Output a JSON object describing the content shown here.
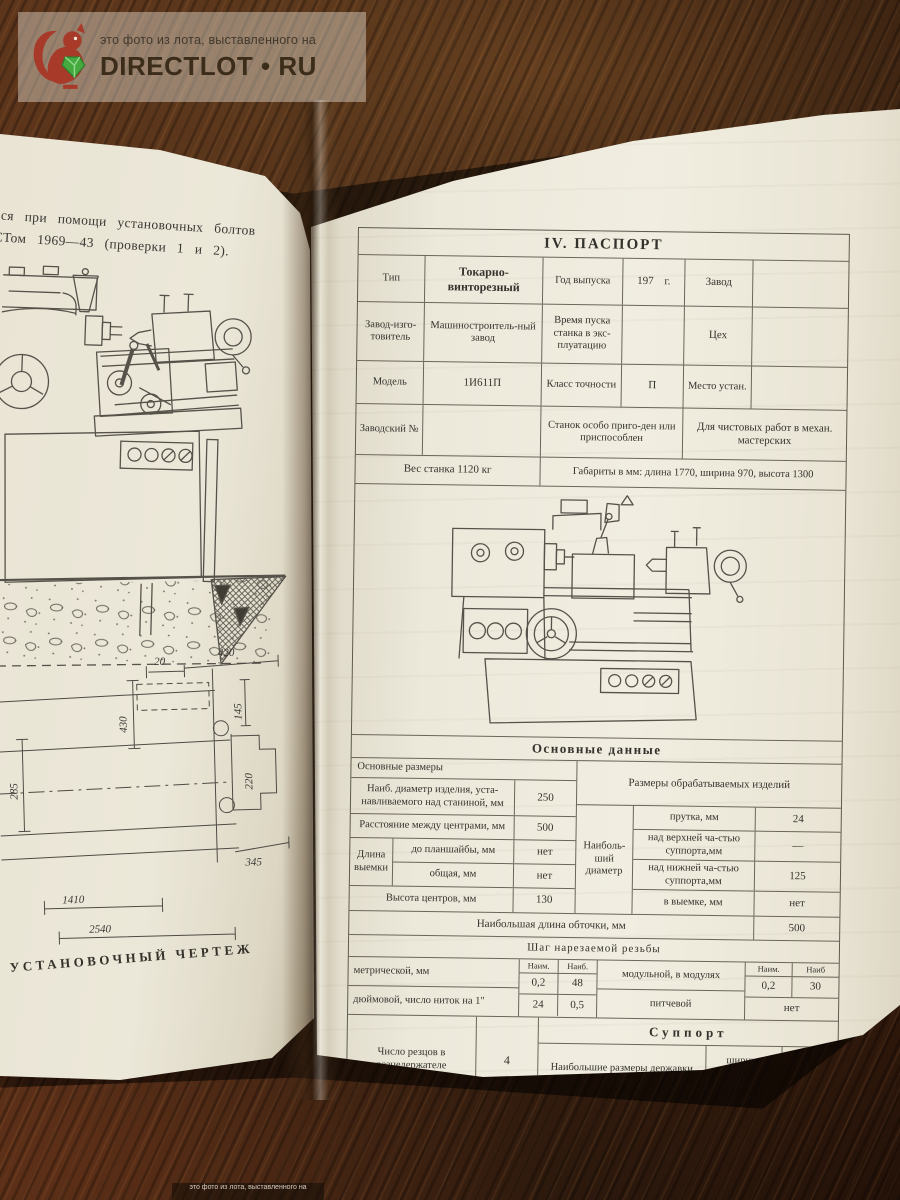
{
  "watermark": {
    "top_line": "это фото из лота, выставленного на",
    "brand": "DIRECTLOT • RU"
  },
  "left_page": {
    "para_line1": "ся при помощи установочных болтов",
    "para_line2": "СТом 1969—43 (проверки 1 и 2).",
    "caption": "УСТАНОВОЧНЫЙ ЧЕРТЕЖ",
    "dims": {
      "a": "20",
      "b": "420",
      "c": "430",
      "d": "145",
      "e": "285",
      "f": "220",
      "g": "345",
      "h": "1410",
      "i": "2540"
    }
  },
  "passport": {
    "title": "IV. ПАСПОРТ",
    "header": {
      "r1c1": "Тип",
      "r1c2": "Токарно-винторезный",
      "r1c3": "Год выпуска",
      "r1c4": "197 г.",
      "r1c5": "Завод",
      "r2c1": "Завод-изго-товитель",
      "r2c2": "Машиностроитель-ный завод",
      "r2c3": "Время пуска станка в экс-плуатацию",
      "r2c5": "Цех",
      "r3c1": "Модель",
      "r3c2": "1И611П",
      "r3c3": "Класс точности",
      "r3c4": "П",
      "r3c5": "Место устан.",
      "r4c1": "Заводский №",
      "r4c3": "Станок особо приго-ден или приспособлен",
      "r4c4": "Для чистовых работ в механ. мастерских",
      "r5c1": "Вес станка 1120 кг",
      "r5c2": "Габариты в мм: длина 1770, ширина 970, высота 1300"
    },
    "main_header": "Основные данные",
    "sizes": {
      "left_header": "Основные размеры",
      "row_diam_label": "Наиб. диаметр изделия, уста-навливаемого над станиной, мм",
      "row_diam_value": "250",
      "row_centers_label": "Расстояние между центрами, мм",
      "row_centers_value": "500",
      "notch_group": "Длина выемки",
      "notch_r1_label": "до планшайбы, мм",
      "notch_r1_value": "нет",
      "notch_r2_label": "общая, мм",
      "notch_r2_value": "нет",
      "row_height_label": "Высота центров, мм",
      "row_height_value": "130",
      "right_header": "Размеры обрабатываемых изделий",
      "diam_group": "Наиболь-ший диаметр",
      "d1_label": "прутка, мм",
      "d1_value": "24",
      "d2_label": "над верхней ча-стью суппорта,мм",
      "d2_value": "—",
      "d3_label": "над нижней ча-стью суппорта,мм",
      "d3_value": "125",
      "d4_label": "в выемке, мм",
      "d4_value": "нет",
      "length_label": "Наибольшая длина обточки, мм",
      "length_value": "500"
    },
    "threads": {
      "header": "Шаг нарезаемой резьбы",
      "min_label": "Наим.",
      "max_label": "Наиб.",
      "metric_label": "метрической, мм",
      "metric_min": "0,2",
      "metric_max": "48",
      "inch_label": "дюймовой, число ниток на 1\"",
      "inch_min": "24",
      "inch_max": "0,5",
      "module_label": "модульной, в модулях",
      "module_min": "0,2",
      "module_max": "30",
      "min_label2": "Наим.",
      "max_label2": "Наиб",
      "pitch_label": "питчевой",
      "pitch_value": "нет"
    },
    "support": {
      "header": "Суппорт",
      "cutters_label": "Число резцов в резцедержателе",
      "cutters_value": "4",
      "holder_label": "Наибольшие размеры державки резцов, мм",
      "width_label": "ширина",
      "width_value": "16",
      "height_label": "высота",
      "height_value": "16"
    },
    "page_number": "7"
  }
}
